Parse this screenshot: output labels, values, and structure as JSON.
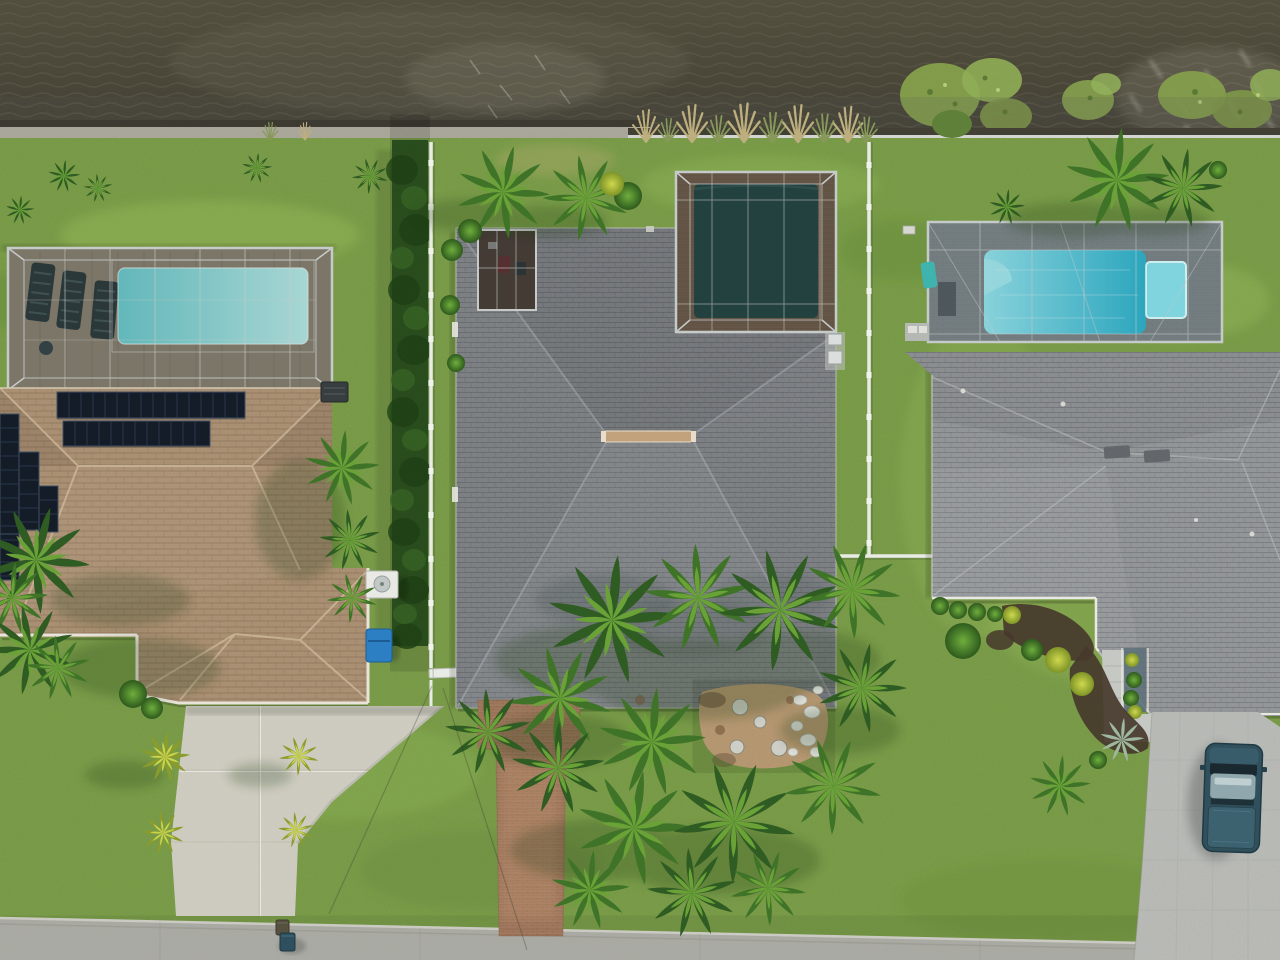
{
  "scene": {
    "type": "aerial-drone-photo",
    "description": "Top-down aerial view of three waterfront homes on a canal with screened pool enclosures, lawns, palms and a street at the bottom",
    "water_body": "canal with rippled dark water, lily pads and shoreline grasses",
    "properties": [
      {
        "id": "left-house",
        "roof": "tan tile",
        "features": [
          "rooftop solar panel arrays",
          "screened pool enclosure with turquoise pool",
          "lounge chairs on pool deck",
          "white concrete driveway",
          "blue recycling bin",
          "two ac units"
        ]
      },
      {
        "id": "center-house",
        "roof": "dark gray shingle",
        "features": [
          "screened pool enclosure with dark pool",
          "brick paver pool deck",
          "small screened lanai",
          "tan ridge vent",
          "red paver front walkway",
          "large palm grove",
          "sand patio with stepping stones and white rocks"
        ]
      },
      {
        "id": "right-house",
        "roof": "light gray shingle",
        "features": [
          "screened pool enclosure with bright blue pool and spa",
          "gray paver driveway",
          "parked dark teal pickup truck",
          "recessed entry with plants",
          "mulched landscape beds",
          "ac pad"
        ]
      }
    ],
    "boundaries": {
      "left_center": "tall green hedge with white fence and gate",
      "center_right": "white fence",
      "shoreline": "concrete seawall cap and white shore fence"
    },
    "street": "light gray road along bottom edge",
    "object_counts": {
      "houses": 3,
      "pool_enclosures": 3,
      "pickup_trucks": 1,
      "curbside_bins": 2,
      "lily_pad_clusters": 3,
      "solar_panel_arrays": 6
    }
  },
  "palette": {
    "water_base": "#54503e",
    "water_ripple": "#6e6956",
    "water_glint": "#eeeee2",
    "seawall": "#b8b4a5",
    "fence_white": "#e9ebe6",
    "grass_base": "#7fa746",
    "grass_light": "#9cc45c",
    "grass_dark": "#5d8a31",
    "hedge_green": "#2f5722",
    "roof_tan": "#b4936f",
    "roof_ridge_vent": "#c2a27c",
    "solar_panel": "#141d27",
    "roof_gray_center": "#83878c",
    "roof_gray_right": "#999da0",
    "porch_wall": "#5a6e78",
    "screen_frame": "#c6cac9",
    "pool_left": "#7fd3d4",
    "pool_center": "#2e5a56",
    "pool_right": "#3fc0d4",
    "spa": "#7fd4dd",
    "deck_tan": "#bfae93",
    "deck_brick": "#9c7a5f",
    "deck_gray": "#a9b2b5",
    "walkway_brick": "#b08263",
    "concrete": "#dad8cb",
    "paver_gray": "#c6c8c3",
    "street": "#b5b5ae",
    "mulch": "#46382c",
    "sand": "#c9a87e",
    "rock_white": "#dfe0da",
    "palm_dark": "#2f5c22",
    "palm_mid": "#3f7428",
    "palm_light": "#6aa238",
    "palm_yellow": "#8a9c2c",
    "palm_yellow_light": "#c9d44e",
    "truck_body": "#31505d",
    "truck_roof": "#8fa7ad",
    "truck_bed": "#3c6270",
    "bin_blue": "#2b7fc2",
    "bin_dark": "#2e4f5e",
    "towel_teal": "#3fb3ad",
    "reed_tan": "#bdae7e",
    "lily_green": "#85a04c"
  }
}
